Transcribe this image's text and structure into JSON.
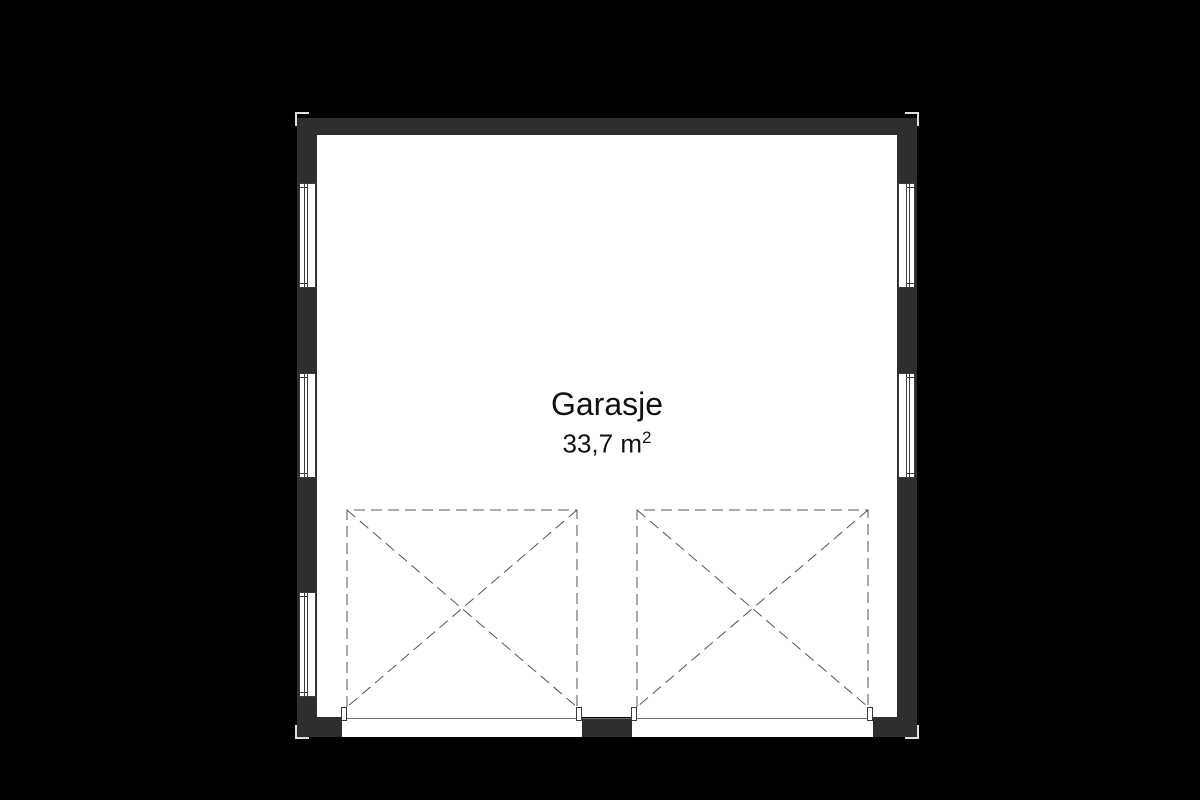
{
  "room": {
    "label": "Garasje",
    "area_value": "33,7",
    "area_unit": "m",
    "area_exponent": "2"
  },
  "colors": {
    "background": "#000000",
    "wall": "#2e2e2e",
    "floor": "#ffffff",
    "outline": "#3a3a3a",
    "dash": "#555555",
    "threshold": "#707070",
    "marker": "#dfdfdf",
    "text": "#111111"
  },
  "structure": {
    "left_window_count": 3,
    "right_window_count": 2,
    "garage_bay_count": 2
  }
}
